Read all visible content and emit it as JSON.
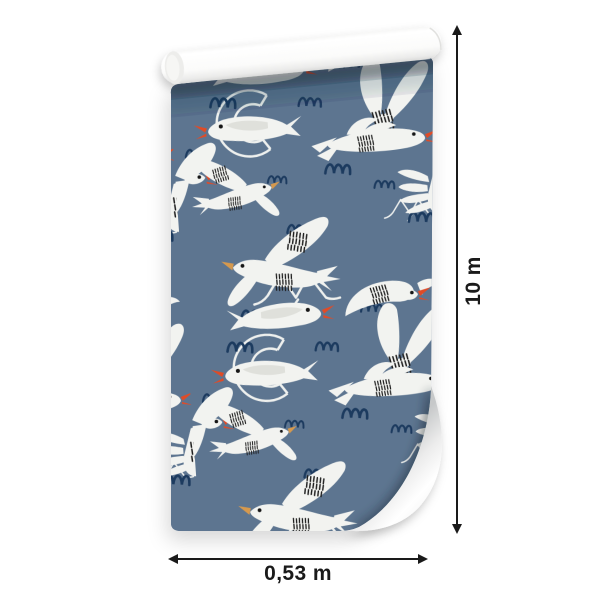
{
  "scene": {
    "type": "product-mockup",
    "subject": "Roll of wallpaper, partially unrolled, decorated with a seagull pattern",
    "background_color": "#ffffff"
  },
  "wallpaper": {
    "pattern": "white seagulls with navy squiggles on slate blue",
    "motifs": [
      "gliding-seagull",
      "big-flying-seagull",
      "swept-wing-seagull",
      "petal-wing-seagull",
      "finger-wing-seagull",
      "edge-seagull",
      "seagull-arc-outline",
      "zigzag-seagull-outline",
      "navy-squiggle",
      "black-stripe-patch"
    ],
    "colors": {
      "base_blue": "#5d7590",
      "bird_white": "#f2f3f0",
      "squiggle_navy": "#1d3a5f",
      "beak_red": "#df4b28",
      "beak_ochre": "#d6994e",
      "stripe_black": "#1c1c1c",
      "roll_paper_white": "#ffffff"
    }
  },
  "dimensions": {
    "height_label": "10 m",
    "width_label": "0,53 m",
    "marker_color": "#1a1a1a"
  }
}
